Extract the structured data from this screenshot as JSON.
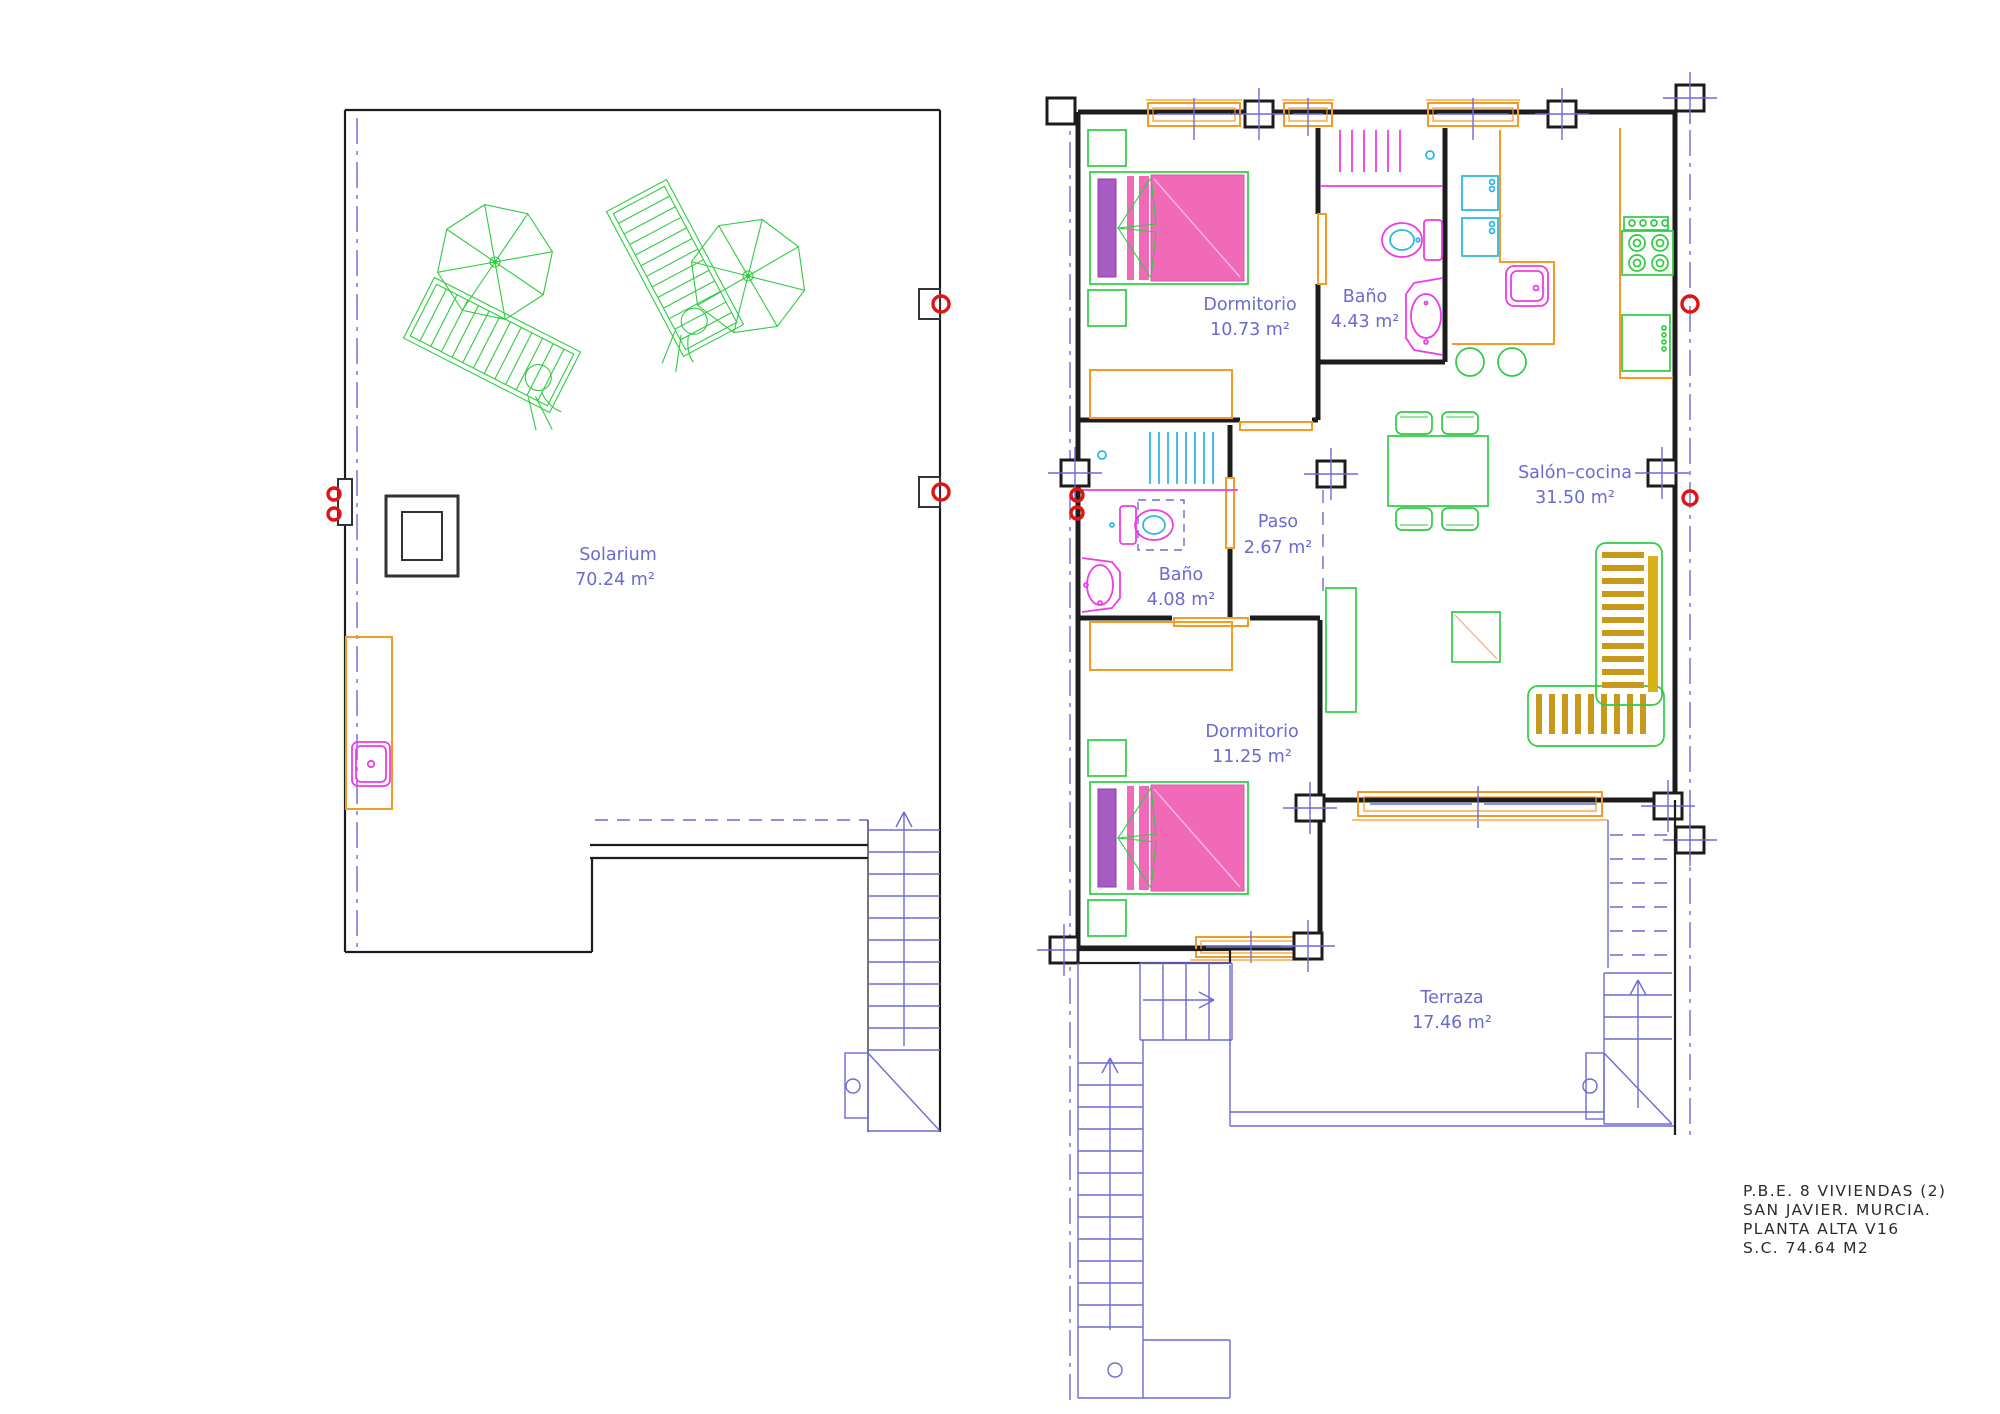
{
  "drawing": {
    "title_block": {
      "line1": "P.B.E. 8 VIVIENDAS (2)",
      "line2": "SAN JAVIER. MURCIA.",
      "line3": "PLANTA ALTA V16",
      "line4": "S.C. 74.64 M2"
    },
    "rooms": {
      "solarium": {
        "name": "Solarium",
        "area": "70.24 m²"
      },
      "dormitorio_1": {
        "name": "Dormitorio",
        "area": "10.73 m²"
      },
      "bano_1": {
        "name": "Baño",
        "area": "4.43 m²"
      },
      "salon_cocina": {
        "name": "Salón–cocina",
        "area": "31.50 m²"
      },
      "paso": {
        "name": "Paso",
        "area": "2.67 m²"
      },
      "bano_2": {
        "name": "Baño",
        "area": "4.08 m²"
      },
      "dormitorio_2": {
        "name": "Dormitorio",
        "area": "11.25 m²"
      },
      "terraza": {
        "name": "Terraza",
        "area": "17.46 m²"
      }
    },
    "palette": {
      "wall_black": "#1c1c1c",
      "furniture_green": "#2ecc40",
      "fixture_magenta": "#ee3ce6",
      "fixture_cyan": "#2fb9e0",
      "joinery_orange": "#f59a23",
      "annotation_blue": "#6a6ad2",
      "marker_red": "#e01414",
      "bed_pink": "#f06ab8",
      "pillow_purple": "#a65cc0",
      "table_gold": "#f5c763",
      "sofa_stripe_gold": "#c9991c",
      "accent_salmon": "#f58d6e"
    }
  }
}
